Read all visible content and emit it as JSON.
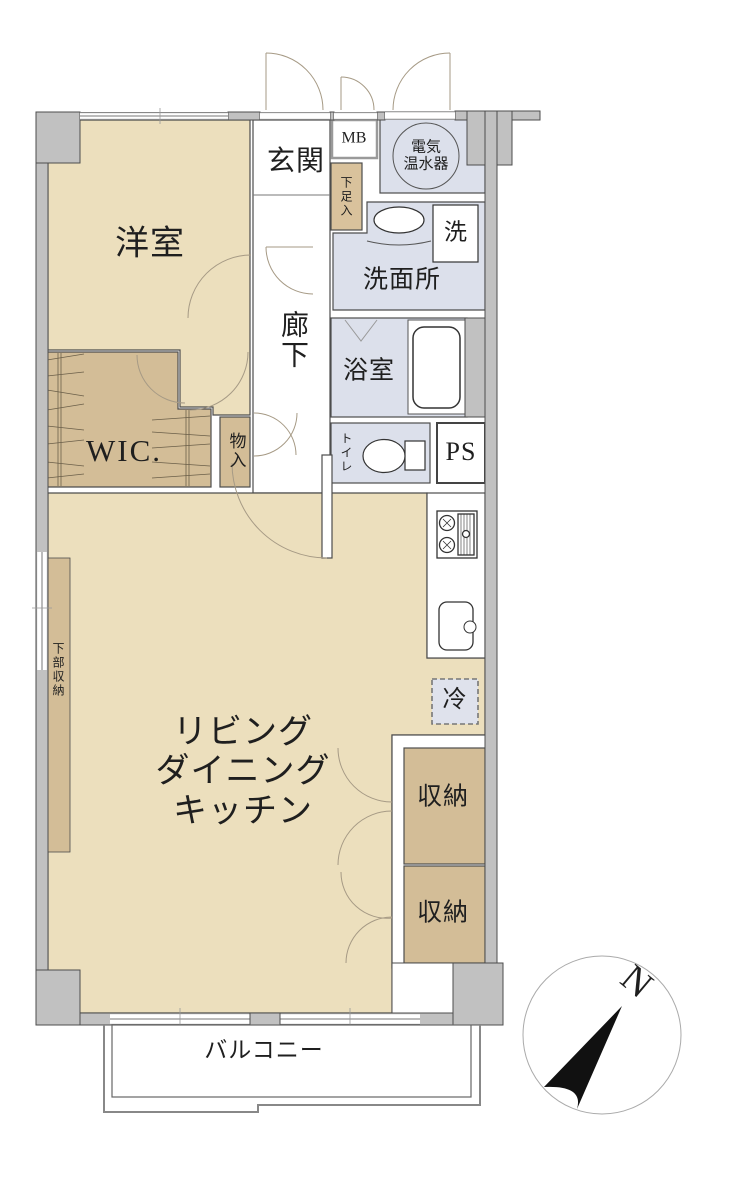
{
  "plan_title": "1LDK apartment floor plan",
  "rooms": {
    "yoshitsu": "洋室",
    "genkan": "玄関",
    "mb": "MB",
    "heater": "電気\n温水器",
    "shoebox": "下足入",
    "washer": "洗",
    "senmenjo": "洗面所",
    "bathroom": "浴室",
    "rouka": "廊下",
    "wic": "WIC.",
    "monoire": "物入",
    "toilet": "トイレ",
    "ps": "PS",
    "fridge": "冷",
    "ldk": "リビング\nダイニング\nキッチン",
    "kabushuno": "下部収納",
    "shuno1": "収納",
    "shuno2": "収納",
    "balcony": "バルコニー",
    "north": "N"
  },
  "colors": {
    "room_beige": "#ECDFBD",
    "storage_tan": "#D3BD97",
    "shoebox_tan": "#D9C29C",
    "wet_area_blue": "#DCE0EB",
    "wall_gray": "#C1C1C1",
    "outline_dark": "#4D4D4D",
    "door_arc": "#A39residual"
  }
}
